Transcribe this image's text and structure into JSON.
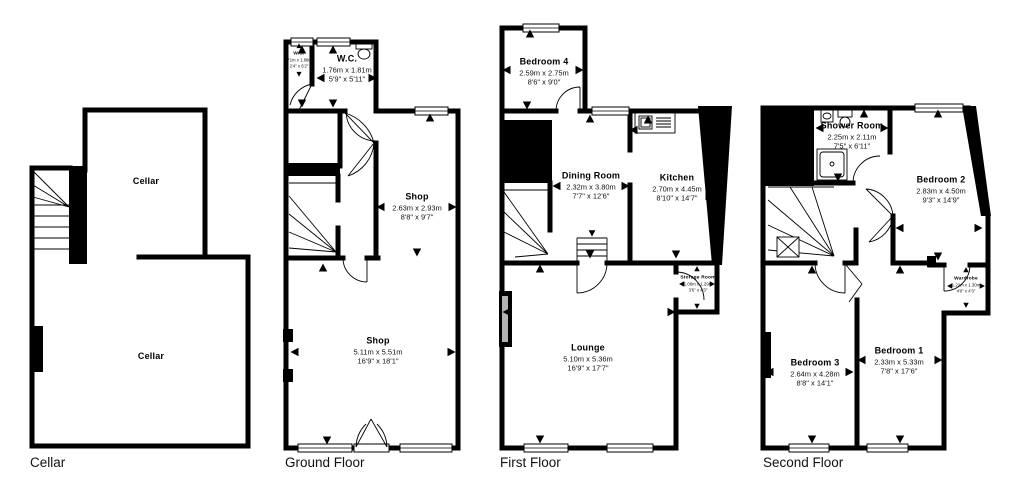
{
  "floors": {
    "cellar": {
      "label": "Cellar"
    },
    "ground": {
      "label": "Ground Floor"
    },
    "first": {
      "label": "First Floor"
    },
    "second": {
      "label": "Second Floor"
    }
  },
  "rooms": {
    "cellar_upper": {
      "name": "Cellar"
    },
    "cellar_lower": {
      "name": "Cellar"
    },
    "wc_small": {
      "name": "W.C.",
      "metric": ".71m x 1.88m",
      "imperial": "2'4\" x 6'2\""
    },
    "wc": {
      "name": "W.C.",
      "metric": "1.76m x 1.81m",
      "imperial": "5'9\" x 5'11\""
    },
    "shop_upper": {
      "name": "Shop",
      "metric": "2.63m x 2.93m",
      "imperial": "8'8\" x 9'7\""
    },
    "shop_lower": {
      "name": "Shop",
      "metric": "5.11m x 5.51m",
      "imperial": "16'9\" x 18'1\""
    },
    "bedroom4": {
      "name": "Bedroom 4",
      "metric": "2.59m x 2.75m",
      "imperial": "8'6\" x 9'0\""
    },
    "dining": {
      "name": "Dining Room",
      "metric": "2.32m x 3.80m",
      "imperial": "7'7\" x 12'6\""
    },
    "kitchen": {
      "name": "Kitchen",
      "metric": "2.70m x 4.45m",
      "imperial": "8'10\" x 14'7\""
    },
    "storage": {
      "name": "Storage Room",
      "metric": "1.06m x 1.29m",
      "imperial": "3'6\" x 4'3\""
    },
    "lounge": {
      "name": "Lounge",
      "metric": "5.10m x 5.36m",
      "imperial": "16'9\" x 17'7\""
    },
    "shower": {
      "name": "Shower Room",
      "metric": "2.25m x 2.11m",
      "imperial": "7'5\" x 6'11\""
    },
    "bedroom2": {
      "name": "Bedroom 2",
      "metric": "2.83m x 4.50m",
      "imperial": "9'3\" x 14'9\""
    },
    "wardrobe": {
      "name": "Wardrobe",
      "metric": "1.22m x 1.30m",
      "imperial": "4'0\" x 4'3\""
    },
    "bedroom3": {
      "name": "Bedroom 3",
      "metric": "2.64m x 4.28m",
      "imperial": "8'8\" x 14'1\""
    },
    "bedroom1": {
      "name": "Bedroom 1",
      "metric": "2.33m x 5.33m",
      "imperial": "7'8\" x 17'6\""
    }
  },
  "colors": {
    "wall": "#000000",
    "background": "#ffffff",
    "text": "#000000"
  }
}
